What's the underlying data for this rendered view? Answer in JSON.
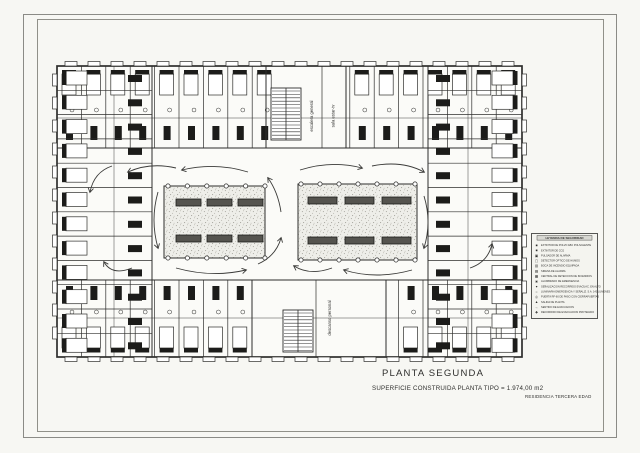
{
  "sheet": {
    "plan_title": "PLANTA SEGUNDA",
    "area_note": "SUPERFICIE CONSTRUIDA PLANTA TIPO = 1.974,00 m2",
    "project_name": "RESIDENCIA TERCERA EDAD"
  },
  "plan_labels": {
    "stair_top": "escalera general",
    "room_top": "sala estar-tv",
    "room_bottom": "descanso personal"
  },
  "legend": {
    "title": "LEYENDA DE SEGURIDAD",
    "rows": [
      {
        "glyph": "■",
        "label": "EXTINTOR DE POLVO ABC POLIVALENTE"
      },
      {
        "glyph": "■",
        "label": "EXTINTOR DE CO2"
      },
      {
        "glyph": "▣",
        "label": "PULSADOR DE ALARMA"
      },
      {
        "glyph": "▢",
        "label": "DETECTOR OPTICO DE HUMOS"
      },
      {
        "glyph": "▥",
        "label": "BOCA DE INCENDIO EQUIPADA"
      },
      {
        "glyph": "▤",
        "label": "SIRENA DE ALARMA"
      },
      {
        "glyph": "▦",
        "label": "CENTRAL DE DETECCION DE INCENDIOS"
      },
      {
        "glyph": "◙",
        "label": "ALUMBRADO DE EMERGENCIA"
      },
      {
        "glyph": "●",
        "label": "SEÑALIZACION RECORRIDO EVACUAC. EN ALTO"
      },
      {
        "glyph": "○",
        "label": "LUMINARIA EMERGENCIA Y SEÑALIZ. S.A. 140 LUMENES"
      },
      {
        "glyph": "◎",
        "label": "PUERTA RF-60 DE PASO CON CIERRAPUERTAS"
      },
      {
        "glyph": "▲",
        "label": "SALIDA DE PLANTA"
      },
      {
        "glyph": "→",
        "label": "SENTIDO DE EVACUACION"
      },
      {
        "glyph": "✚",
        "label": "RECORRIDO DE EVACUACION PROTEGIDO"
      }
    ]
  },
  "colors": {
    "ink": "#2e2e2c",
    "paper": "#f7f7f3",
    "dark_fill": "#1c1c1a",
    "bench_fill": "#55544f",
    "stipple": "#a9a8a0",
    "frame": "#8b8b86"
  }
}
